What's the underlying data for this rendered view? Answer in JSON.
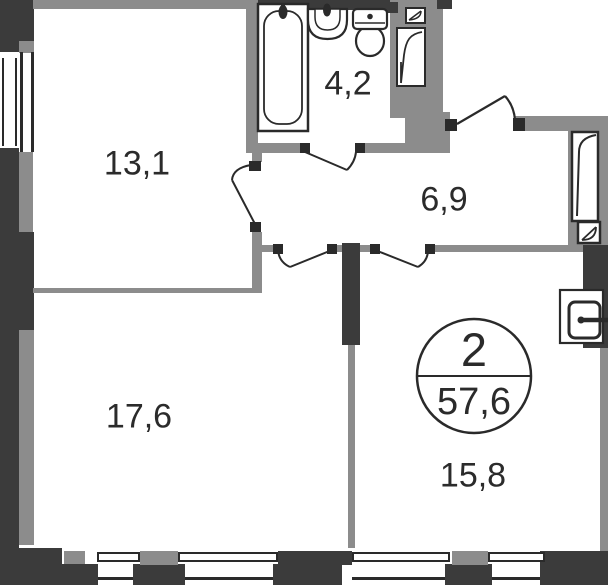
{
  "plan": {
    "rooms": [
      {
        "name": "room-top-left",
        "area_label": "13,1"
      },
      {
        "name": "bathroom",
        "area_label": "4,2"
      },
      {
        "name": "hallway",
        "area_label": "6,9"
      },
      {
        "name": "room-bottom-left",
        "area_label": "17,6"
      },
      {
        "name": "room-bottom-right",
        "area_label": "15,8"
      }
    ],
    "summary_badge": {
      "rooms_count": "2",
      "total_area": "57,6"
    },
    "colors": {
      "wall_dark": "#3b3b3b",
      "wall_gray": "#8c8c8c",
      "line": "#2a2a2a",
      "background": "#ffffff"
    },
    "icons": [
      "bathtub-icon",
      "sink-icon",
      "toilet-icon",
      "vent-shaft-icon",
      "door-swing-icon",
      "entry-door-icon",
      "electrical-panel-icon",
      "window-icon"
    ]
  }
}
